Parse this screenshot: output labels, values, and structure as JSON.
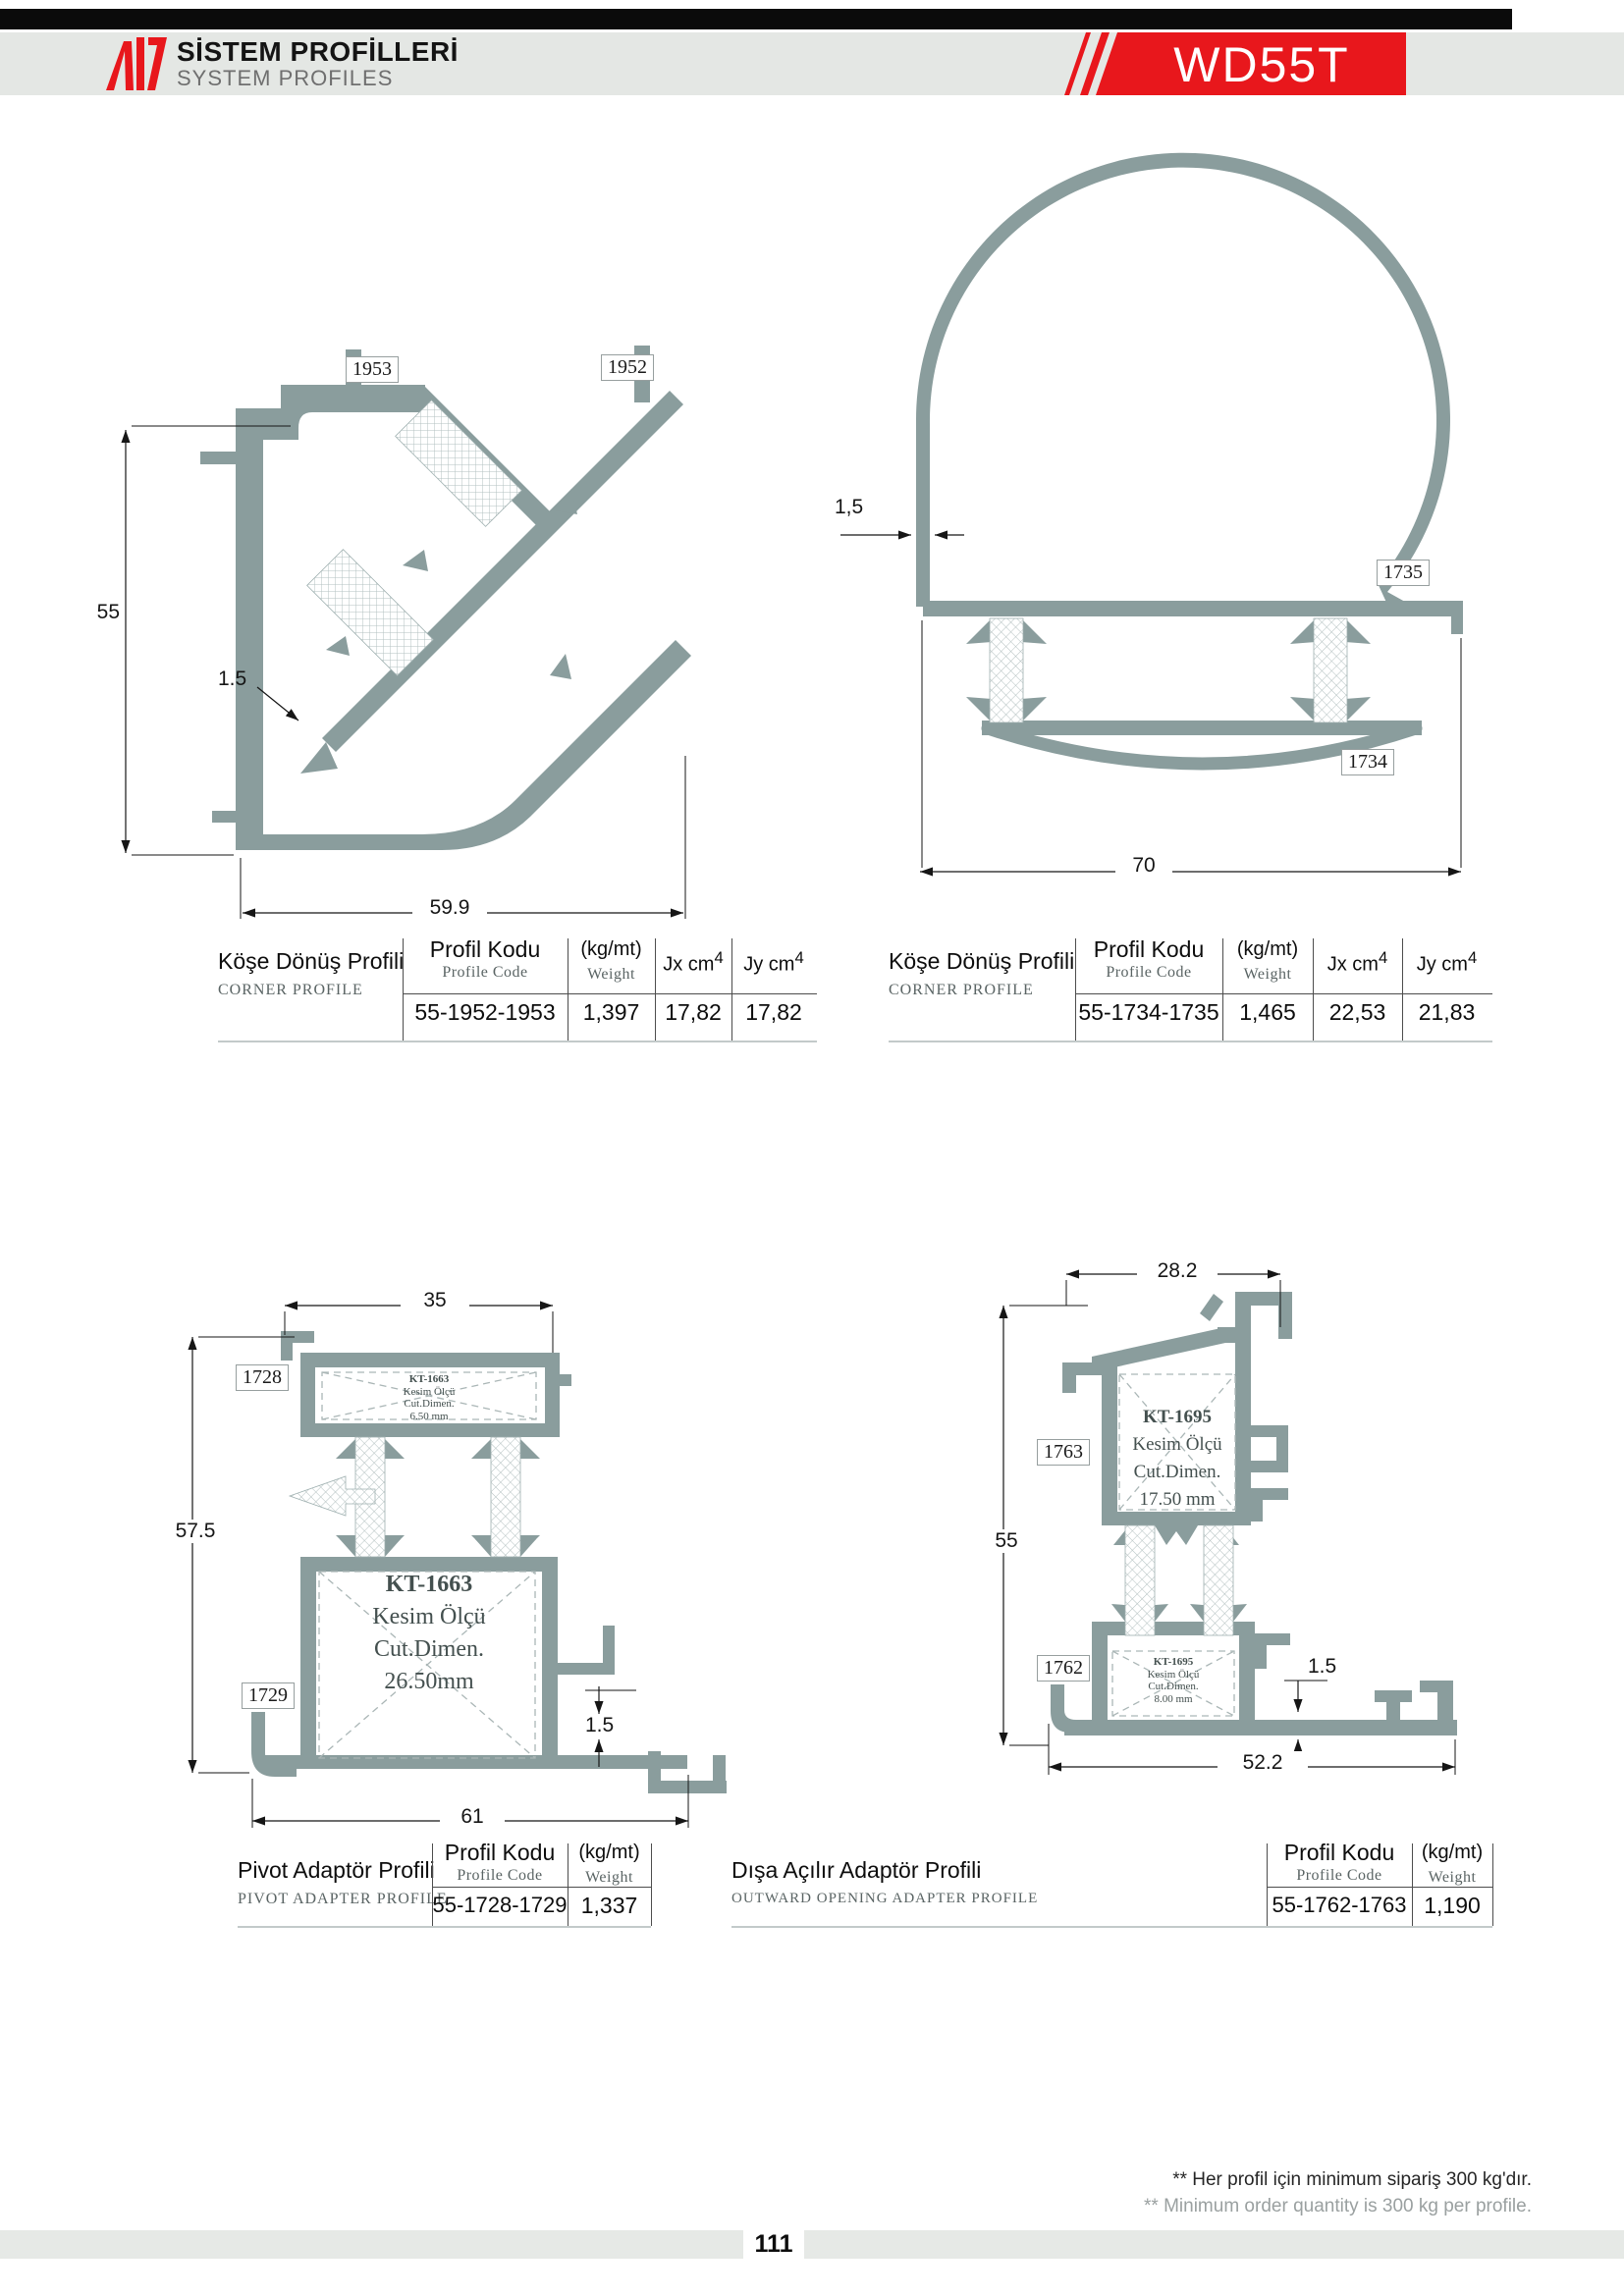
{
  "header": {
    "brand_title": "SİSTEM PROFİLLERİ",
    "brand_subtitle": "SYSTEM PROFILES",
    "series": "WD55T"
  },
  "colors": {
    "accent_red": "#e8171c",
    "profile_gray": "#8a9d9d"
  },
  "columns": {
    "code_tr": "Profil Kodu",
    "code_en": "Profile Code",
    "weight_tr": "(kg/mt)",
    "weight_en": "Weight",
    "jx_base": "Jx cm",
    "jy_base": "Jy cm",
    "sup": "4"
  },
  "tables": [
    {
      "title_tr": "Köşe Dönüş Profili",
      "title_en": "CORNER PROFILE",
      "code": "55-1952-1953",
      "weight": "1,397",
      "jx": "17,82",
      "jy": "17,82"
    },
    {
      "title_tr": "Köşe Dönüş Profili",
      "title_en": "CORNER PROFILE",
      "code": "55-1734-1735",
      "weight": "1,465",
      "jx": "22,53",
      "jy": "21,83"
    },
    {
      "title_tr": "Pivot Adaptör Profili",
      "title_en": "PIVOT ADAPTER PROFILE",
      "code": "55-1728-1729",
      "weight": "1,337"
    },
    {
      "title_tr": "Dışa Açılır Adaptör Profili",
      "title_en": "OUTWARD OPENING ADAPTER PROFILE",
      "code": "55-1762-1763",
      "weight": "1,190"
    }
  ],
  "drawings": {
    "d1": {
      "label_a": "1953",
      "label_b": "1952",
      "dim_height": "55",
      "dim_wall": "1.5",
      "dim_width": "59.9"
    },
    "d2": {
      "label_a": "1735",
      "label_b": "1734",
      "dim_wall": "1,5",
      "dim_width": "70"
    },
    "d3": {
      "label_a": "1728",
      "label_b": "1729",
      "dim_top": "35",
      "dim_height": "57.5",
      "dim_width": "61",
      "dim_wall": "1.5",
      "note_small": {
        "code": "KT-1663",
        "l1": "Kesim Ölçü",
        "l2": "Cut.Dimen.",
        "val": "6.50 mm"
      },
      "note_big": {
        "code": "KT-1663",
        "l1": "Kesim Ölçü",
        "l2": "Cut.Dimen.",
        "val": "26.50mm"
      }
    },
    "d4": {
      "label_a": "1763",
      "label_b": "1762",
      "dim_top": "28.2",
      "dim_height": "55",
      "dim_width": "52.2",
      "dim_wall": "1.5",
      "note_big": {
        "code": "KT-1695",
        "l1": "Kesim Ölçü",
        "l2": "Cut.Dimen.",
        "val": "17.50 mm"
      },
      "note_small": {
        "code": "KT-1695",
        "l1": "Kesim Ölçü",
        "l2": "Cut.Dimen.",
        "val": "8.00 mm"
      }
    }
  },
  "footer": {
    "note_tr": "** Her profil için minimum sipariş 300 kg'dır.",
    "note_en": "** Minimum order quantity is 300 kg per profile.",
    "page": "111"
  }
}
